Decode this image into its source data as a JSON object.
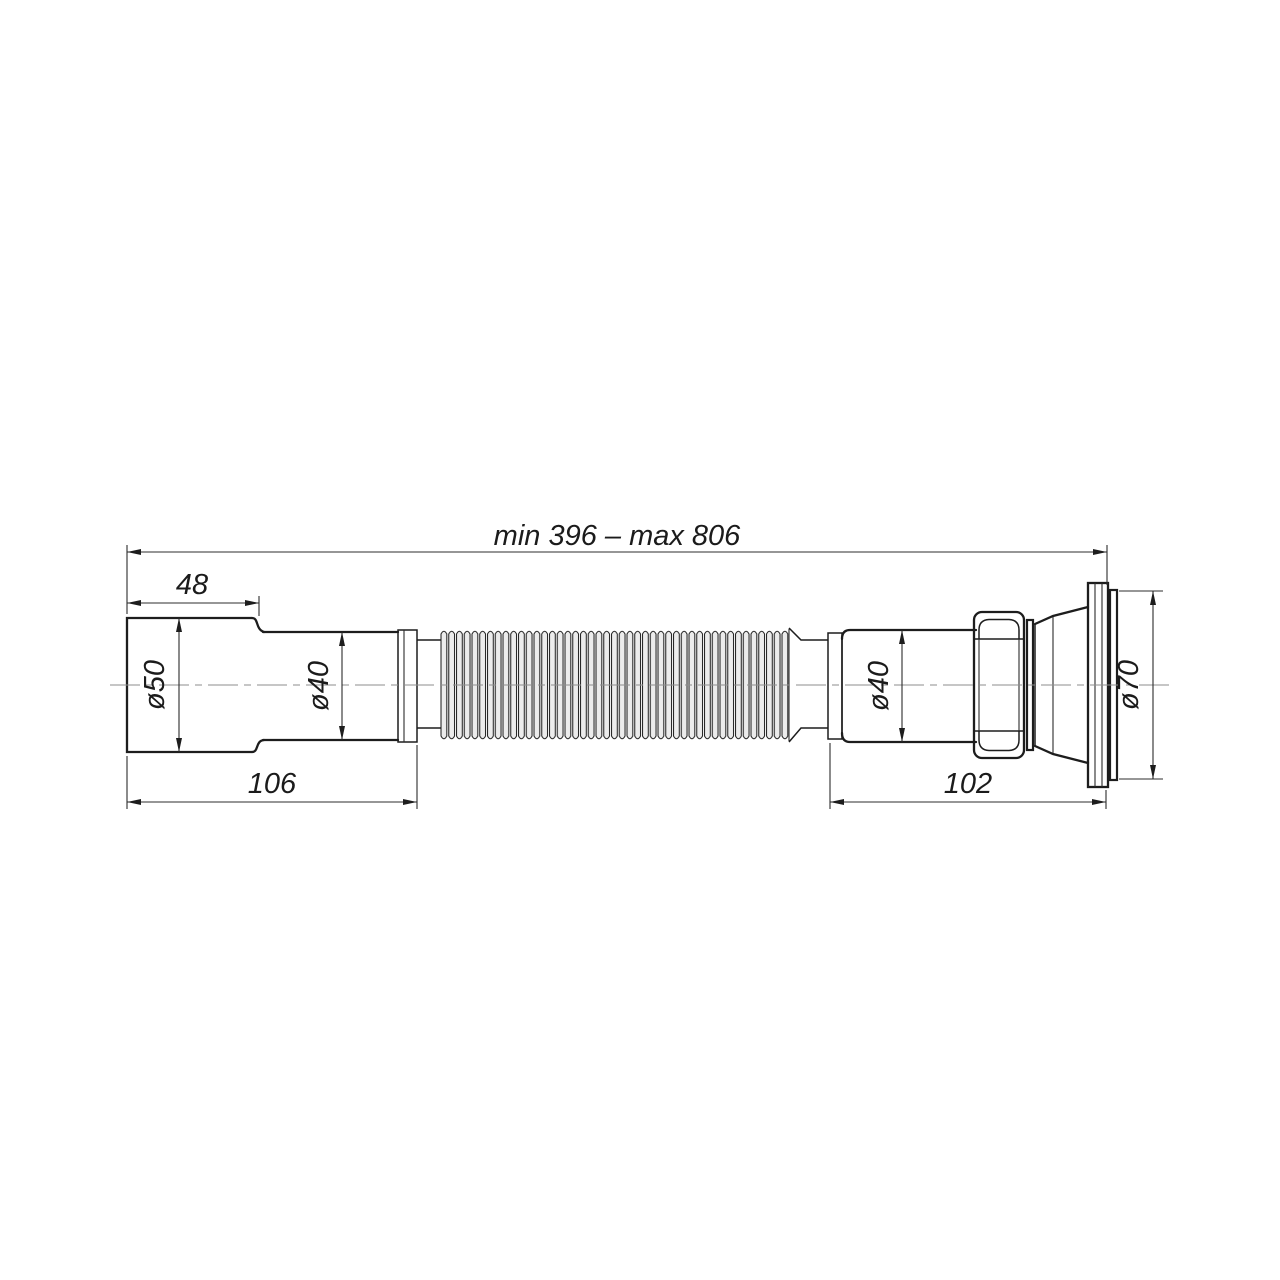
{
  "drawing": {
    "type": "technical-drawing",
    "subject": "flexible corrugated drain pipe (sink waste connector), side view",
    "background_color": "#ffffff",
    "outline_color": "#1d1d1d",
    "centerline_color": "#8d8d8d",
    "dimensions": {
      "overall_length": "min 396 – max 806",
      "inlet_socket_length": "48",
      "inlet_diameter": "ø50",
      "left_tail_length": "106",
      "left_tube_diameter": "ø40",
      "right_tube_diameter": "ø40",
      "right_tail_length": "102",
      "outlet_flange_diameter": "ø70"
    }
  }
}
